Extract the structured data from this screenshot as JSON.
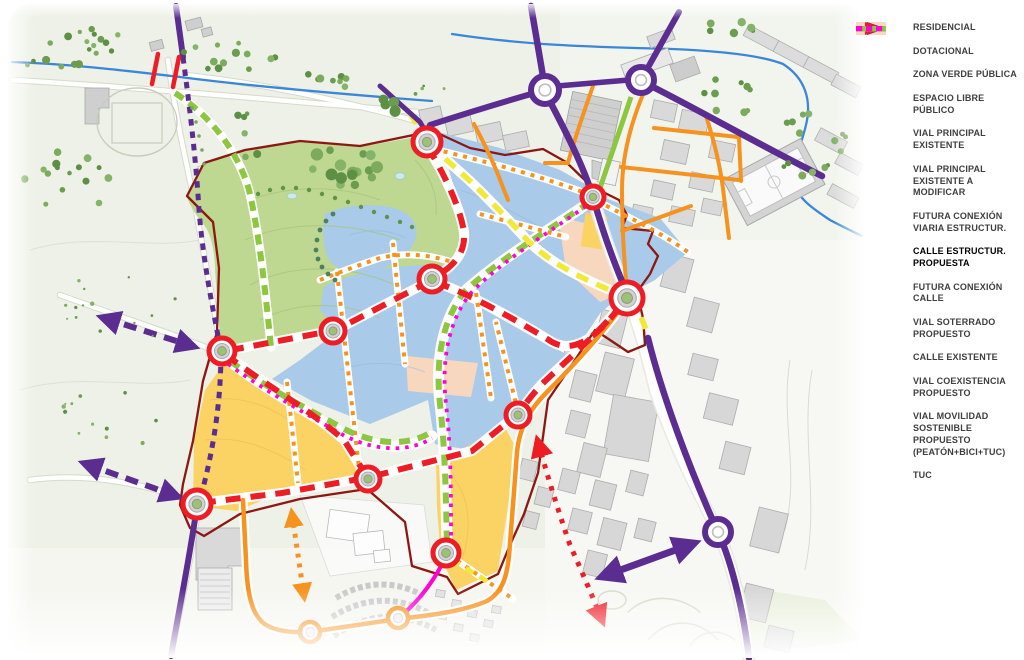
{
  "figure": {
    "kind": "urban-planning-scheme-map",
    "title": ""
  },
  "legend": {
    "items": [
      {
        "key": "residencial",
        "type": "swatch",
        "color": "#aecbe7",
        "label": "RESIDENCIAL"
      },
      {
        "key": "dotacional",
        "type": "swatch",
        "color": "#fbd365",
        "label": "DOTACIONAL"
      },
      {
        "key": "zona-verde-publica",
        "type": "swatch",
        "color": "#cde5af",
        "label": "ZONA VERDE PÚBLICA"
      },
      {
        "key": "espacio-libre-publico",
        "type": "swatch",
        "color": "#f9d8c1",
        "label": "ESPACIO LIBRE PÚBLICO"
      },
      {
        "key": "vial-principal-existente",
        "type": "line",
        "color": "#5c2d91",
        "label": "VIAL PRINCIPAL EXISTENTE"
      },
      {
        "key": "vial-principal-existente-a-modificar",
        "type": "dashes",
        "color": "#5c2d91",
        "label": "VIAL PRINCIPAL EXISTENTE A MODIFICAR"
      },
      {
        "key": "futura-conexion-viaria-estructur",
        "type": "arrow",
        "color": "#5c2d91",
        "label": "FUTURA CONEXIÓN VIARIA ESTRUCTUR."
      },
      {
        "key": "calle-estructur-propuesta",
        "type": "long-dashes",
        "color": "#ee1c24",
        "label": "CALLE ESTRUCTUR. PROPUESTA",
        "bold": true
      },
      {
        "key": "futura-conexion-calle",
        "type": "arrow-dotted",
        "color": "#ee1c24",
        "label": "FUTURA CONEXIÓN CALLE"
      },
      {
        "key": "vial-soterrado-propuesto",
        "type": "long-dashes",
        "color": "#fdf23a",
        "label": "VIAL SOTERRADO PROPUESTO"
      },
      {
        "key": "calle-existente",
        "type": "line",
        "color": "#f6921e",
        "label": "CALLE EXISTENTE"
      },
      {
        "key": "vial-coexistencia-propuesto",
        "type": "dashes",
        "color": "#f6921e",
        "label": "VIAL COEXISTENCIA PROPUESTO"
      },
      {
        "key": "vial-movilidad-sostenible",
        "type": "line",
        "color": "#8dc63f",
        "label": "VIAL MOVILIDAD SOSTENIBLE PROPUESTO (PEATÓN+BICI+TUC)"
      },
      {
        "key": "tuc",
        "type": "dashes",
        "color": "#ff00d5",
        "label": "TUC"
      }
    ]
  },
  "map": {
    "palette": {
      "residential": "#a9cae8",
      "dotacional": "#fbd365",
      "zona_verde": "#bed791",
      "espacio_libre": "#f8d7bf",
      "vial_principal": "#5c2d91",
      "calle_estructurante": "#ee1c24",
      "vial_soterrado": "#f2e838",
      "calle_existente": "#f6921e",
      "vial_movilidad": "#8dc63f",
      "tuc": "#ff00d5",
      "boundary": "#8c1713",
      "stream": "#3a87d9",
      "terrain": "#eef1e7"
    },
    "roundabouts": {
      "structural_red": 10,
      "existing_purple": 3,
      "existing_orange": 2
    }
  }
}
